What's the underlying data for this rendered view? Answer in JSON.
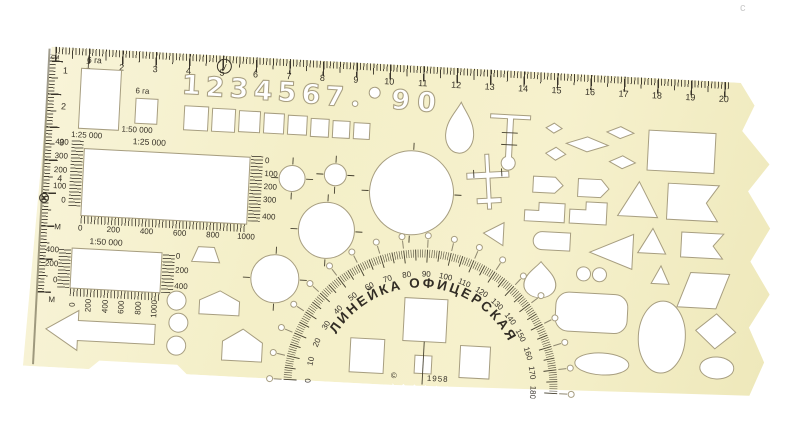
{
  "colors": {
    "body": "#f6f1cd",
    "ink": "#39342a",
    "cutout_stroke": "#a79e80",
    "background": "#ffffff"
  },
  "watermark": "с",
  "top_ruler": {
    "unit": "см",
    "numbers": [
      "1",
      "2",
      "3",
      "4",
      "5",
      "6",
      "7",
      "8",
      "9",
      "10",
      "11",
      "12",
      "13",
      "14",
      "15",
      "16",
      "17",
      "18",
      "19",
      "20"
    ]
  },
  "left_ruler": {
    "numbers": [
      "1",
      "2",
      "3",
      "4"
    ]
  },
  "circled_symbol": "у",
  "crossed_circle_symbol": "⊗",
  "digits_row": [
    "1",
    "2",
    "3",
    "4",
    "5",
    "6",
    "7",
    "9",
    "0"
  ],
  "hectare_large": {
    "label": "6 га",
    "scale": "1:25 000"
  },
  "hectare_small": {
    "label": "6 га",
    "scale": "1:50 000"
  },
  "scale_25000": {
    "title": "1:25 000",
    "unit": "М",
    "left_labels": [
      "400",
      "300",
      "200",
      "100",
      "0"
    ],
    "right_labels": [
      "0",
      "100",
      "200",
      "300",
      "400"
    ],
    "bottom_labels": [
      "0",
      "200",
      "400",
      "600",
      "800",
      "1000"
    ]
  },
  "scale_50000": {
    "title": "1:50 000",
    "unit": "М",
    "left_labels": [
      "400",
      "200",
      "0"
    ],
    "right_labels": [
      "0",
      "200",
      "400"
    ],
    "bottom_labels": [
      "0",
      "200",
      "400",
      "600",
      "800",
      "1000"
    ]
  },
  "protractor": {
    "arc_text": "ЛИНЕЙКА ОФИЦЕРСКАЯ",
    "degrees": [
      "0",
      "10",
      "20",
      "30",
      "40",
      "50",
      "60",
      "70",
      "80",
      "90",
      "100",
      "110",
      "120",
      "130",
      "140",
      "150",
      "160",
      "170",
      "180"
    ]
  },
  "footer": {
    "mark": "©",
    "year": "1958"
  }
}
